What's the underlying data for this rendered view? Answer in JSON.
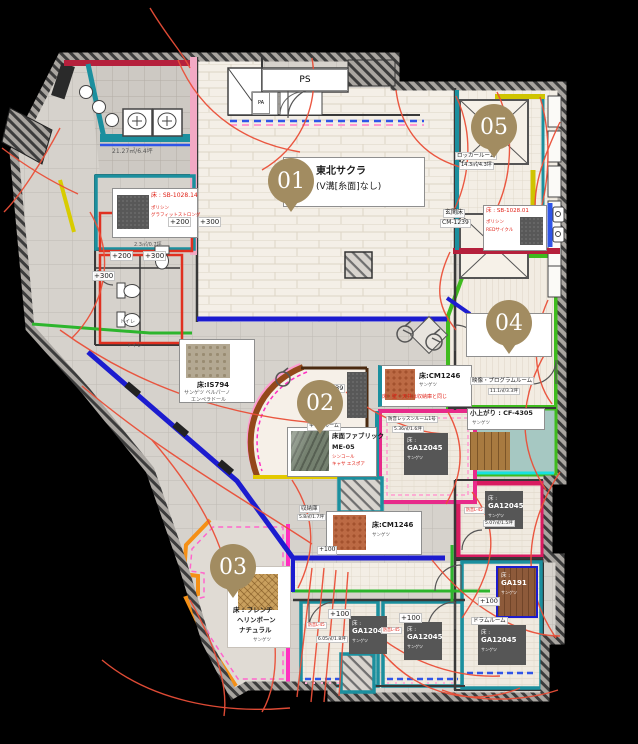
{
  "colors": {
    "badge": "#a28c61",
    "red_cable": "#ea4f38",
    "magenta": "#e82a8a",
    "pink_line": "#ff30c0",
    "green": "#3fbb1e",
    "teal": "#1b8f9e",
    "blue": "#1c1ccf",
    "orange": "#f59016",
    "yellow": "#d8cc00",
    "crimson": "#b5203c"
  },
  "t": {
    "b01": "01",
    "b02": "02",
    "b03": "03",
    "b04": "04",
    "b05": "05",
    "ps": "PS",
    "pa": "PA",
    "area_wash": "21.27㎡/6.4坪",
    "sb14_title": "床 : SB-1028.14",
    "sb14_s1": "ポリシン",
    "sb14_s2": "グラフィットストロング",
    "area_wc": "2.3㎡/0.7坪",
    "p200": "+200",
    "p300": "+300",
    "p100": "+100",
    "wc": "トイレ",
    "hall1": "東北サクラ",
    "hall2": "(V溝[糸面]なし)",
    "locker": "ロッカールーム",
    "area_locker": "14.3㎡/4.3坪",
    "genkan1": "玄関床",
    "genkan2": "CM-1239",
    "sb01_title": "床 : SB-1028.01",
    "sb01_s1": "ポリシン",
    "sb01_s2": "REDサイクル",
    "program": "映像・プログラムルーム",
    "area_program": "11.1㎡/3.3坪",
    "koagari": "小上がり : CF-4305",
    "maker": "サンゲツ",
    "is794": "床:IS794",
    "is794_s1": "サンゲツ ベルパーノ",
    "is794_s2": "エンペラドール",
    "kids": "キッズルーム",
    "fabric": "床面ファブリック",
    "me05": "ME-05",
    "fab_s1": "シンコール",
    "fab_s2": "キャサ エスポア",
    "n239": "239",
    "cm1246": "床:CM1246",
    "note_same": "床・壁・天井は収納庫と同じ",
    "lesson1": "防音レッスンルーム1号",
    "area_l1": "5.36㎡/1.6坪",
    "ga_f": "床 :",
    "ga12045": "GA12045",
    "ga191": "GA191",
    "storage": "収納庫",
    "area_storage": "5.8㎡/1.7坪",
    "herr1": "床 : フレンチ",
    "herr2": "ヘリンボーン",
    "herr3": "ナチュラル",
    "l45": "防音L-45",
    "area_a": "6.05㎡/1.8坪",
    "area_p": "5.07㎡/1.5坪",
    "drum": "ドラムルーム"
  }
}
